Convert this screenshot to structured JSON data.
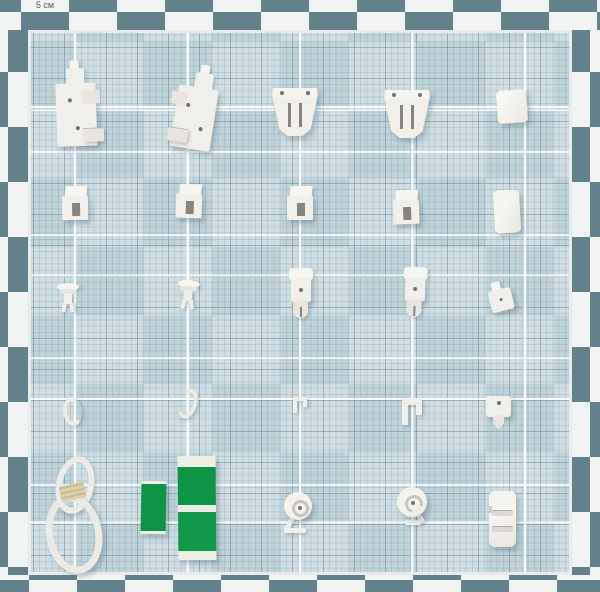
{
  "board": {
    "description": "Top-down photo of white plastic curtain and roller-blind fittings arranged in a five-by-five grid on a checkered graph-paper measurement board",
    "scale_label": "5 см"
  },
  "colors": {
    "border_dark": "#64808a",
    "border_light": "#f2f4f3",
    "paper_base": "#c0d3d9",
    "paper_tile_light": "#d2e0e5",
    "grid_line": "#6d8fa0",
    "major_line": "#ffffff",
    "plastic_white": "#f1efe9",
    "tape_green": "#12994a",
    "band_beige": "#dcd0ae"
  },
  "grid": {
    "rows": 5,
    "columns": 5
  },
  "objects": [
    {
      "label": "wall bracket (left)"
    },
    {
      "label": "wall bracket (right)"
    },
    {
      "label": "cassette bracket A"
    },
    {
      "label": "cassette bracket B"
    },
    {
      "label": "end cap"
    },
    {
      "label": "square clip 1"
    },
    {
      "label": "square clip 2"
    },
    {
      "label": "square clip 3"
    },
    {
      "label": "square clip 4"
    },
    {
      "label": "spacer block"
    },
    {
      "label": "push rivet 1"
    },
    {
      "label": "push rivet 2"
    },
    {
      "label": "cord guide A"
    },
    {
      "label": "cord guide B"
    },
    {
      "label": "hook plate"
    },
    {
      "label": "curved hook (left)"
    },
    {
      "label": "curved hook (right)"
    },
    {
      "label": "mini clip A"
    },
    {
      "label": "mini clip B"
    },
    {
      "label": "adhesive hook"
    },
    {
      "label": "cord loop"
    },
    {
      "label": "adhesive strip (small)"
    },
    {
      "label": "adhesive strips (large)"
    },
    {
      "label": "cord tidy A"
    },
    {
      "label": "cord tidy B"
    },
    {
      "label": "mounting plate"
    }
  ]
}
